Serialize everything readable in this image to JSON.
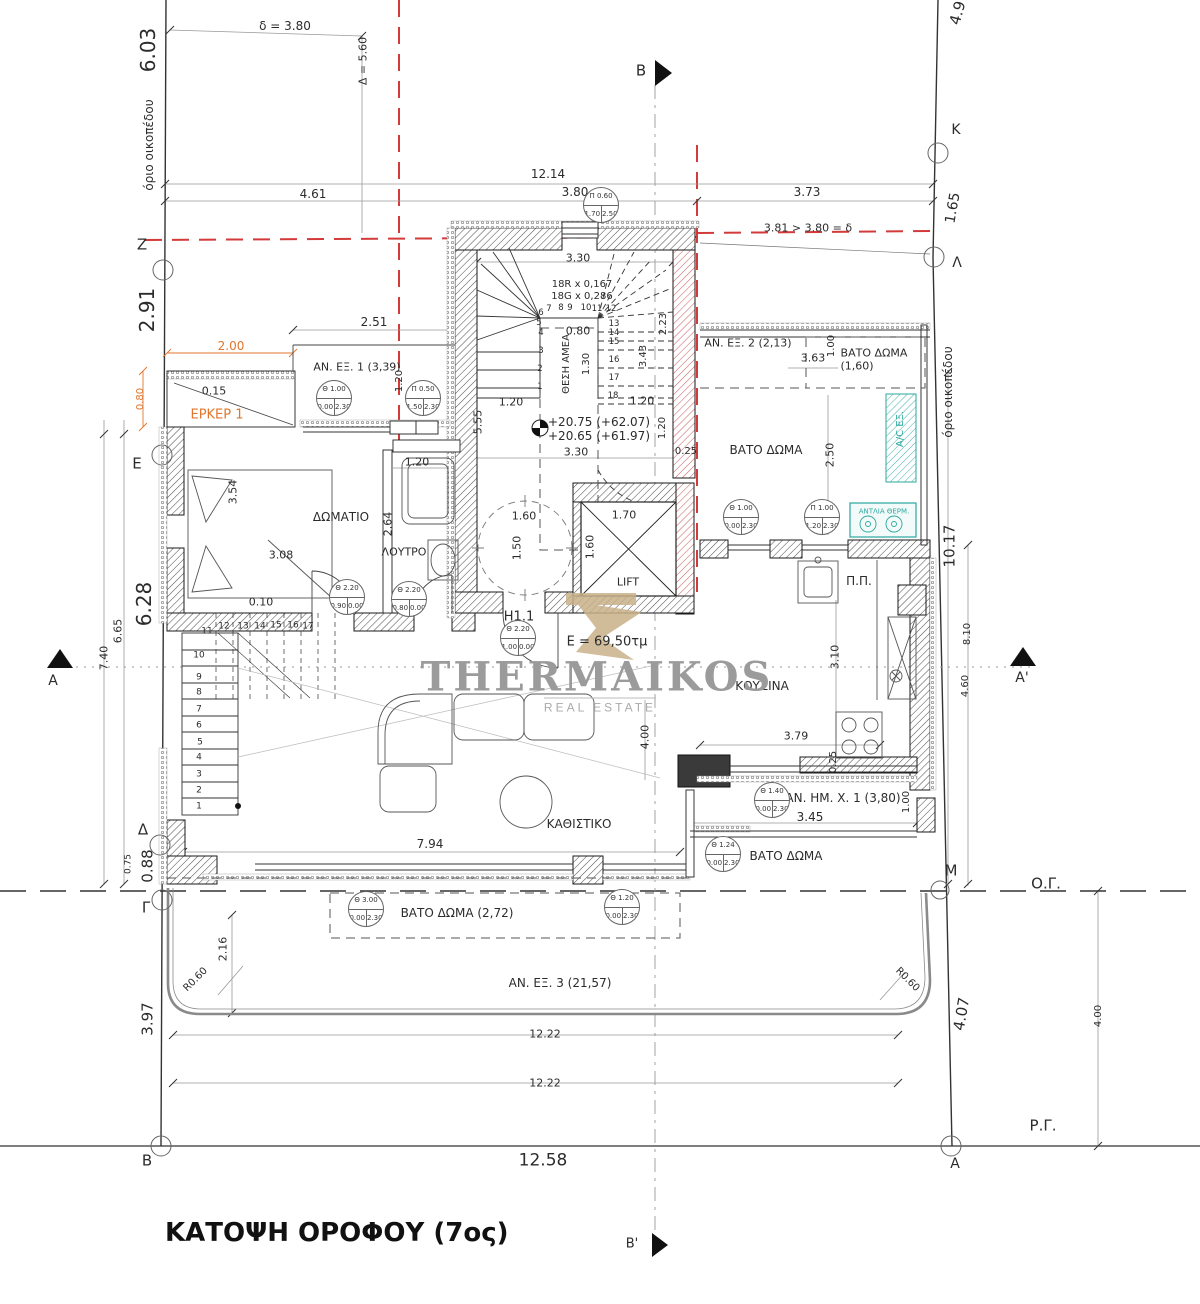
{
  "title": "ΚΑΤΟΨΗ ΟΡΟΦΟΥ (7ος)",
  "watermark": {
    "name": "THERMAIKOS",
    "subtitle": "REAL ESTATE"
  },
  "colors": {
    "orange": "#e0762e",
    "teal": "#2ba79e",
    "red": "#d33a3a",
    "gray": "#9b9b9b",
    "tan": "#c9b189"
  },
  "area_total": "E = 69,50τμ",
  "levels": [
    "+20.75 (+62.07)",
    "+20.65 (+61.97)"
  ],
  "labels": [
    {
      "t": "6.03",
      "x": 148,
      "y": 50,
      "r": -90,
      "s": 20,
      "n": "dim-6.03"
    },
    {
      "t": "όριο οικοπέδου",
      "x": 149,
      "y": 145,
      "r": -90,
      "s": 12,
      "n": "plot-boundary-label-left"
    },
    {
      "t": "δ = 3.80",
      "x": 285,
      "y": 26,
      "s": 12
    },
    {
      "t": "Δ = 5.60",
      "x": 363,
      "y": 61,
      "r": -90,
      "s": 11
    },
    {
      "t": "12.14",
      "x": 548,
      "y": 174,
      "s": 12
    },
    {
      "t": "4.61",
      "x": 313,
      "y": 194,
      "s": 12
    },
    {
      "t": "3.80",
      "x": 575,
      "y": 192,
      "s": 12
    },
    {
      "t": "3.73",
      "x": 807,
      "y": 192,
      "s": 12
    },
    {
      "t": "3.81 > 3.80 = δ",
      "x": 808,
      "y": 228,
      "s": 11
    },
    {
      "t": "B",
      "x": 641,
      "y": 71,
      "s": 15,
      "n": "section-marker-B"
    },
    {
      "t": "B'",
      "x": 632,
      "y": 1244,
      "s": 13,
      "n": "section-marker-B2"
    },
    {
      "t": "4.9",
      "x": 958,
      "y": 13,
      "r": -75,
      "s": 15
    },
    {
      "t": "K",
      "x": 956,
      "y": 130,
      "s": 14,
      "n": "boundary-point-K"
    },
    {
      "t": "1.65",
      "x": 953,
      "y": 208,
      "r": -80,
      "s": 14
    },
    {
      "t": "Λ",
      "x": 957,
      "y": 263,
      "s": 14,
      "n": "boundary-point-L"
    },
    {
      "t": "Z",
      "x": 142,
      "y": 245,
      "s": 15,
      "n": "boundary-point-Z"
    },
    {
      "t": "2.91",
      "x": 147,
      "y": 310,
      "r": -90,
      "s": 20
    },
    {
      "t": "2.51",
      "x": 374,
      "y": 322,
      "s": 12
    },
    {
      "t": "2.00",
      "x": 231,
      "y": 346,
      "s": 12,
      "c": "orange"
    },
    {
      "t": "ΑΝ. ΕΞ. 1 (3,39)",
      "x": 357,
      "y": 367,
      "s": 11,
      "n": "room-label-an-ex-1"
    },
    {
      "t": "0.15",
      "x": 214,
      "y": 391,
      "s": 11
    },
    {
      "t": "ΕΡΚΕΡ 1",
      "x": 217,
      "y": 415,
      "s": 13,
      "c": "orange",
      "n": "room-label-erker-1"
    },
    {
      "t": "0.80",
      "x": 141,
      "y": 399,
      "r": -90,
      "s": 10,
      "c": "orange"
    },
    {
      "t": "1.20",
      "x": 400,
      "y": 381,
      "r": -90,
      "s": 10
    },
    {
      "t": "Ε",
      "x": 137,
      "y": 464,
      "s": 15,
      "n": "boundary-point-E"
    },
    {
      "t": "3.54",
      "x": 233,
      "y": 492,
      "r": -90,
      "s": 11
    },
    {
      "t": "ΔΩΜΑΤΙΟ",
      "x": 341,
      "y": 517,
      "s": 12,
      "n": "room-label-bedroom"
    },
    {
      "t": "3.08",
      "x": 281,
      "y": 555,
      "s": 11
    },
    {
      "t": "ΛΟΥΤΡΟ",
      "x": 404,
      "y": 552,
      "s": 11,
      "n": "room-label-bathroom"
    },
    {
      "t": "2.64",
      "x": 388,
      "y": 524,
      "r": -90,
      "s": 11
    },
    {
      "t": "1.20",
      "x": 417,
      "y": 462,
      "s": 11
    },
    {
      "t": "0.10",
      "x": 261,
      "y": 602,
      "s": 11
    },
    {
      "t": "5.55",
      "x": 478,
      "y": 422,
      "r": -90,
      "s": 11
    },
    {
      "t": "3.30",
      "x": 578,
      "y": 258,
      "s": 11
    },
    {
      "t": "18R x 0,167",
      "x": 582,
      "y": 285,
      "s": 10
    },
    {
      "t": "18G x 0,286",
      "x": 582,
      "y": 297,
      "s": 10
    },
    {
      "t": "0.80",
      "x": 578,
      "y": 331,
      "s": 11
    },
    {
      "t": "ΘΕΣΗ ΑΜΕΑ",
      "x": 567,
      "y": 364,
      "r": -90,
      "s": 10,
      "n": "label-wheelchair-spot"
    },
    {
      "t": "1.30",
      "x": 587,
      "y": 364,
      "r": -90,
      "s": 10
    },
    {
      "t": "2.23",
      "x": 664,
      "y": 324,
      "r": -90,
      "s": 10
    },
    {
      "t": "3.43",
      "x": 644,
      "y": 356,
      "r": -90,
      "s": 10
    },
    {
      "t": "1.20",
      "x": 511,
      "y": 402,
      "s": 11
    },
    {
      "t": "1.20",
      "x": 642,
      "y": 401,
      "s": 11
    },
    {
      "t": "1.20",
      "x": 663,
      "y": 428,
      "r": -90,
      "s": 10
    },
    {
      "t": "+20.75 (+62.07)",
      "x": 599,
      "y": 422,
      "s": 12,
      "n": "level-annotation-1"
    },
    {
      "t": "+20.65 (+61.97)",
      "x": 599,
      "y": 436,
      "s": 12,
      "n": "level-annotation-2"
    },
    {
      "t": "3.30",
      "x": 576,
      "y": 452,
      "s": 11
    },
    {
      "t": "0.25",
      "x": 686,
      "y": 452,
      "s": 10
    },
    {
      "t": "1.60",
      "x": 524,
      "y": 516,
      "s": 11
    },
    {
      "t": "1.50",
      "x": 517,
      "y": 548,
      "r": -90,
      "s": 11
    },
    {
      "t": "1.70",
      "x": 624,
      "y": 515,
      "s": 11
    },
    {
      "t": "1.60",
      "x": 590,
      "y": 547,
      "r": -90,
      "s": 11
    },
    {
      "t": "LIFT",
      "x": 628,
      "y": 582,
      "s": 11,
      "n": "room-label-lift"
    },
    {
      "t": "H1.1",
      "x": 519,
      "y": 617,
      "s": 13,
      "n": "unit-label-h1-1"
    },
    {
      "t": "E = 69,50τμ",
      "x": 607,
      "y": 642,
      "s": 13,
      "n": "area-label"
    },
    {
      "t": "ΑΝ. ΕΞ. 2 (2,13)",
      "x": 748,
      "y": 343,
      "s": 11,
      "n": "room-label-an-ex-2"
    },
    {
      "t": "3.63",
      "x": 813,
      "y": 358,
      "s": 11
    },
    {
      "t": "1.00",
      "x": 832,
      "y": 346,
      "r": -90,
      "s": 10
    },
    {
      "t": "ΒΑΤΟ ΔΩΜΑ",
      "x": 874,
      "y": 353,
      "s": 11,
      "n": "room-label-bato-doma-160"
    },
    {
      "t": "(1,60)",
      "x": 857,
      "y": 366,
      "s": 11
    },
    {
      "t": "ΒΑΤΟ ΔΩΜΑ",
      "x": 766,
      "y": 450,
      "s": 12,
      "n": "room-label-bato-doma-ne"
    },
    {
      "t": "2.50",
      "x": 830,
      "y": 455,
      "r": -90,
      "s": 11
    },
    {
      "t": "A/C ΕΞ.",
      "x": 901,
      "y": 429,
      "r": -90,
      "s": 10,
      "c": "teal",
      "n": "label-ac-unit"
    },
    {
      "t": "όριο οικοπέδου",
      "x": 948,
      "y": 392,
      "r": -90,
      "s": 12,
      "n": "plot-boundary-label-right"
    },
    {
      "t": "ΑΝΤΛΙΑ ΘΕΡΜ.",
      "x": 884,
      "y": 512,
      "s": 7,
      "c": "teal",
      "n": "label-heat-pump"
    },
    {
      "t": "10.17",
      "x": 950,
      "y": 546,
      "r": -90,
      "s": 15
    },
    {
      "t": "8.10",
      "x": 968,
      "y": 634,
      "r": -90,
      "s": 10
    },
    {
      "t": "4.60",
      "x": 966,
      "y": 686,
      "r": -90,
      "s": 10
    },
    {
      "t": "A'",
      "x": 1022,
      "y": 678,
      "s": 14,
      "n": "section-marker-A2"
    },
    {
      "t": "A",
      "x": 53,
      "y": 681,
      "s": 14,
      "n": "section-marker-A"
    },
    {
      "t": "6.28",
      "x": 144,
      "y": 604,
      "r": -90,
      "s": 20
    },
    {
      "t": "6.65",
      "x": 118,
      "y": 631,
      "r": -90,
      "s": 11
    },
    {
      "t": "7.40",
      "x": 104,
      "y": 658,
      "r": -90,
      "s": 11
    },
    {
      "t": "Π.Π.",
      "x": 859,
      "y": 581,
      "s": 12,
      "n": "label-washing-machine"
    },
    {
      "t": "ΚΟΥΖΙΝΑ",
      "x": 762,
      "y": 686,
      "s": 12,
      "n": "room-label-kitchen"
    },
    {
      "t": "3.10",
      "x": 835,
      "y": 657,
      "r": -90,
      "s": 11
    },
    {
      "t": "3.79",
      "x": 796,
      "y": 736,
      "s": 11
    },
    {
      "t": "0.25",
      "x": 834,
      "y": 762,
      "r": -90,
      "s": 10
    },
    {
      "t": "4.00",
      "x": 645,
      "y": 737,
      "r": -90,
      "s": 11
    },
    {
      "t": "ΚΑΘΙΣΤΙΚΟ",
      "x": 579,
      "y": 824,
      "s": 12,
      "n": "room-label-living"
    },
    {
      "t": "7.94",
      "x": 430,
      "y": 844,
      "s": 12
    },
    {
      "t": "ΑΝ. ΗΜ. Χ. 1 (3,80)",
      "x": 843,
      "y": 798,
      "s": 12,
      "n": "room-label-an-im-x-1"
    },
    {
      "t": "3.45",
      "x": 810,
      "y": 817,
      "s": 12
    },
    {
      "t": "1.00",
      "x": 907,
      "y": 802,
      "r": -90,
      "s": 10
    },
    {
      "t": "ΒΑΤΟ ΔΩΜΑ",
      "x": 786,
      "y": 856,
      "s": 12,
      "n": "room-label-bato-doma-se"
    },
    {
      "t": "M",
      "x": 951,
      "y": 871,
      "s": 15,
      "n": "boundary-point-M"
    },
    {
      "t": "Ο.Γ.",
      "x": 1046,
      "y": 884,
      "s": 15,
      "n": "label-building-line"
    },
    {
      "t": "R0.60",
      "x": 907,
      "y": 980,
      "r": 45,
      "s": 10
    },
    {
      "t": "R0.60",
      "x": 196,
      "y": 980,
      "r": -45,
      "s": 10
    },
    {
      "t": "2.16",
      "x": 223,
      "y": 949,
      "r": -90,
      "s": 11
    },
    {
      "t": "Γ",
      "x": 146,
      "y": 908,
      "s": 15,
      "n": "boundary-point-G"
    },
    {
      "t": "Δ",
      "x": 143,
      "y": 830,
      "s": 15,
      "n": "boundary-point-D"
    },
    {
      "t": "0.88",
      "x": 148,
      "y": 866,
      "r": -90,
      "s": 15
    },
    {
      "t": "0.75",
      "x": 129,
      "y": 864,
      "r": -90,
      "s": 9
    },
    {
      "t": "3.97",
      "x": 148,
      "y": 1019,
      "r": -90,
      "s": 15
    },
    {
      "t": "ΒΑΤΟ ΔΩΜΑ (2,72)",
      "x": 457,
      "y": 913,
      "s": 12,
      "n": "room-label-bato-doma-272"
    },
    {
      "t": "ΑΝ. ΕΞ. 3 (21,57)",
      "x": 560,
      "y": 983,
      "s": 12,
      "n": "room-label-an-ex-3"
    },
    {
      "t": "12.22",
      "x": 545,
      "y": 1034,
      "s": 11
    },
    {
      "t": "12.22",
      "x": 545,
      "y": 1083,
      "s": 11
    },
    {
      "t": "12.58",
      "x": 543,
      "y": 1161,
      "s": 17
    },
    {
      "t": "4.07",
      "x": 962,
      "y": 1014,
      "r": -80,
      "s": 15
    },
    {
      "t": "4.00",
      "x": 1099,
      "y": 1016,
      "r": -90,
      "s": 10
    },
    {
      "t": "Ρ.Γ.",
      "x": 1043,
      "y": 1126,
      "s": 15,
      "n": "label-street-line"
    },
    {
      "t": "B",
      "x": 147,
      "y": 1161,
      "s": 15,
      "n": "boundary-point-B"
    },
    {
      "t": "A",
      "x": 955,
      "y": 1164,
      "s": 14,
      "n": "boundary-point-A"
    },
    {
      "t": "1",
      "x": 540,
      "y": 387,
      "s": 8.5
    },
    {
      "t": "2",
      "x": 540,
      "y": 369,
      "s": 8.5
    },
    {
      "t": "3",
      "x": 541,
      "y": 351,
      "s": 8.5
    },
    {
      "t": "4",
      "x": 541,
      "y": 333,
      "s": 8.5
    },
    {
      "t": "5",
      "x": 539,
      "y": 323,
      "s": 8.5
    },
    {
      "t": "6",
      "x": 541,
      "y": 313,
      "s": 8.5
    },
    {
      "t": "7",
      "x": 549,
      "y": 309,
      "s": 8.5
    },
    {
      "t": "8",
      "x": 561,
      "y": 308,
      "s": 8.5
    },
    {
      "t": "9",
      "x": 570,
      "y": 308,
      "s": 8.5
    },
    {
      "t": "10",
      "x": 586,
      "y": 308,
      "s": 8.5
    },
    {
      "t": "11",
      "x": 597,
      "y": 309,
      "s": 8.5
    },
    {
      "t": "12",
      "x": 611,
      "y": 309,
      "s": 8.5
    },
    {
      "t": "13",
      "x": 614,
      "y": 324,
      "s": 8.5
    },
    {
      "t": "14",
      "x": 614,
      "y": 333,
      "s": 8.5
    },
    {
      "t": "15",
      "x": 614,
      "y": 342,
      "s": 8.5
    },
    {
      "t": "16",
      "x": 614,
      "y": 360,
      "s": 8.5
    },
    {
      "t": "17",
      "x": 614,
      "y": 378,
      "s": 8.5
    },
    {
      "t": "18",
      "x": 613,
      "y": 396,
      "s": 8.5
    },
    {
      "t": "10",
      "x": 199,
      "y": 656,
      "s": 9
    },
    {
      "t": "9",
      "x": 199,
      "y": 678,
      "s": 9
    },
    {
      "t": "8",
      "x": 199,
      "y": 693,
      "s": 9
    },
    {
      "t": "7",
      "x": 199,
      "y": 710,
      "s": 9
    },
    {
      "t": "6",
      "x": 199,
      "y": 726,
      "s": 9
    },
    {
      "t": "5",
      "x": 200,
      "y": 743,
      "s": 9
    },
    {
      "t": "4",
      "x": 199,
      "y": 758,
      "s": 9
    },
    {
      "t": "3",
      "x": 199,
      "y": 775,
      "s": 9
    },
    {
      "t": "2",
      "x": 199,
      "y": 791,
      "s": 9
    },
    {
      "t": "1",
      "x": 199,
      "y": 807,
      "s": 9
    },
    {
      "t": "11",
      "x": 207,
      "y": 632,
      "s": 9
    },
    {
      "t": "12",
      "x": 224,
      "y": 627,
      "s": 9
    },
    {
      "t": "13",
      "x": 243,
      "y": 627,
      "s": 9
    },
    {
      "t": "14",
      "x": 260,
      "y": 627,
      "s": 9
    },
    {
      "t": "15",
      "x": 276,
      "y": 626,
      "s": 9
    },
    {
      "t": "16",
      "x": 293,
      "y": 626,
      "s": 9
    },
    {
      "t": "17",
      "x": 308,
      "y": 627,
      "s": 9
    }
  ],
  "tags": [
    {
      "top": "Π 0.60",
      "bl": "1.70",
      "br": "2.50",
      "x": 601,
      "y": 205
    },
    {
      "top": "Θ 1.00",
      "bl": "0.00",
      "br": "2.30",
      "x": 334,
      "y": 398
    },
    {
      "top": "Π 0.50",
      "bl": "1.50",
      "br": "2.30",
      "x": 423,
      "y": 398
    },
    {
      "top": "Θ 1.00",
      "bl": "0.00",
      "br": "2.30",
      "x": 741,
      "y": 517
    },
    {
      "top": "Π 1.00",
      "bl": "1.20",
      "br": "2.30",
      "x": 822,
      "y": 517
    },
    {
      "top": "Θ 2.20",
      "bl": "0.90",
      "br": "0.00",
      "x": 347,
      "y": 597
    },
    {
      "top": "Θ 2.20",
      "bl": "0.80",
      "br": "0.00",
      "x": 409,
      "y": 599
    },
    {
      "top": "Θ 2.20",
      "bl": "1.00",
      "br": "0.00",
      "x": 518,
      "y": 638
    },
    {
      "top": "Θ 1.40",
      "bl": "0.00",
      "br": "2.30",
      "x": 772,
      "y": 800
    },
    {
      "top": "Θ 1.24",
      "bl": "0.00",
      "br": "2.30",
      "x": 723,
      "y": 854
    },
    {
      "top": "Θ 3.00",
      "bl": "0.00",
      "br": "2.30",
      "x": 366,
      "y": 909
    },
    {
      "top": "Θ 1.20",
      "bl": "0.00",
      "br": "2.30",
      "x": 622,
      "y": 907
    }
  ]
}
